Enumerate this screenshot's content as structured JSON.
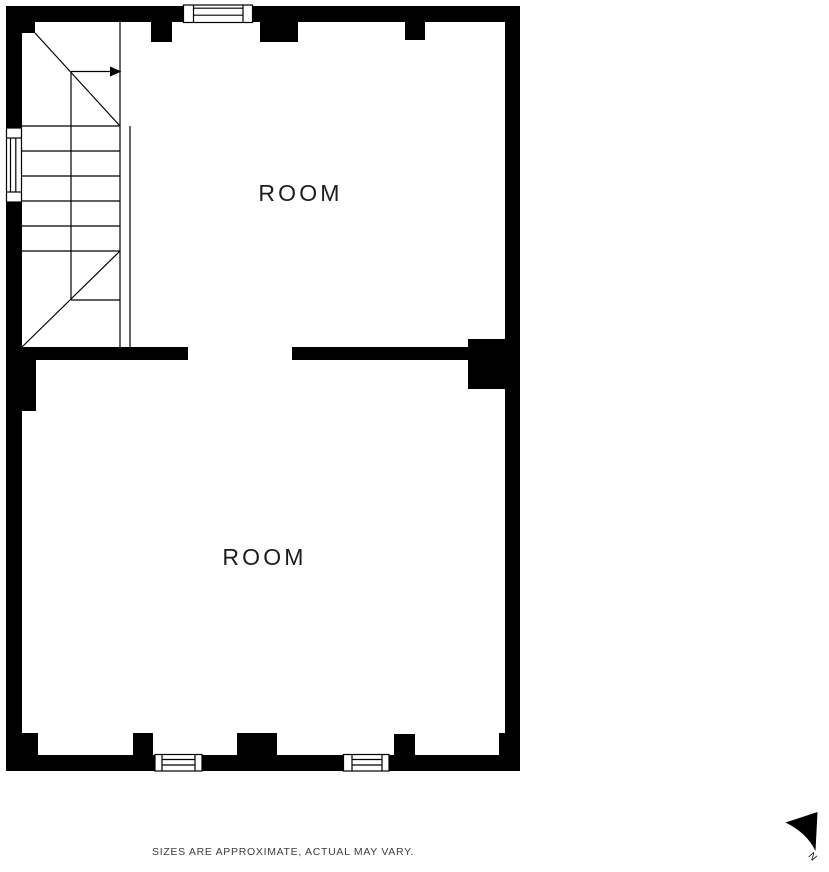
{
  "floorplan": {
    "upper_room": {
      "label": "ROOM"
    },
    "lower_room": {
      "label": "ROOM"
    },
    "disclaimer": "SIZES ARE APPROXIMATE, ACTUAL MAY VARY.",
    "compass": {
      "label": "N"
    },
    "colors": {
      "wall": "#000000",
      "background": "#ffffff",
      "room_label": "#1d1d1d",
      "disclaimer_text": "#3d3d3d"
    }
  }
}
